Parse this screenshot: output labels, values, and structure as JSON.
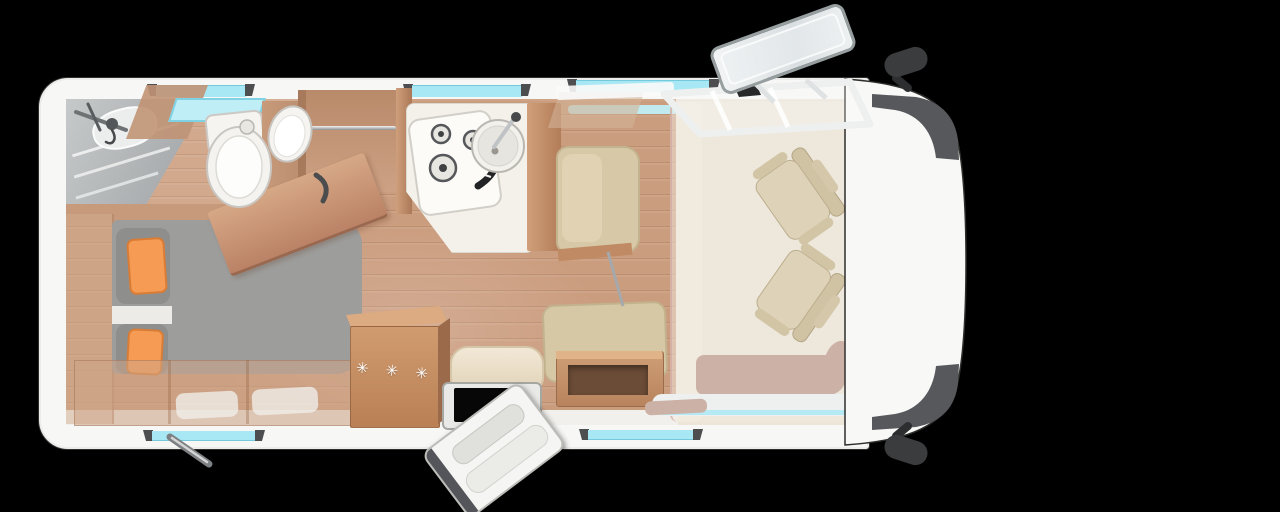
{
  "meta": {
    "description": "Top-down 3D floor plan render of a motorhome on a black background",
    "background_color": "#000000"
  },
  "fridge": {
    "marker": "✳ ✳ ✳"
  },
  "palette": {
    "body_white": "#f7f7f5",
    "floor_wood": "#c89878",
    "bath_floor_wood": "#d2a98d",
    "window_cyan": "#a8e7f4",
    "window_cap_gray": "#4c4e50",
    "accent_orange": "#f59b53",
    "blanket_orange": "#f79a4e",
    "mattress_gray": "#9d9d9b",
    "upholstery_khaki": "#d6c8a6",
    "cab_seat_beige": "#ded3b8",
    "furniture_wood": "#c08a64",
    "windshield_gray": "#56585c",
    "mirror_dark": "#3a3c3e",
    "rose_step": "#ccb2a6",
    "cream_floor_cab": "#ece5d8"
  },
  "features": {
    "bathroom": [
      "shower-fixture",
      "shower-shelves",
      "toilet",
      "washbasin",
      "bathroom-rooflight",
      "open-bathroom-door"
    ],
    "bedroom": [
      "french-bed",
      "head-cushions",
      "orange-pillows",
      "orange-blanket",
      "under-bed-storage",
      "rear-wardrobe-column"
    ],
    "kitchen": [
      "three-burner-hob",
      "round-sink",
      "kitchen-counter",
      "tall-cabinet",
      "wardrobe-with-rail"
    ],
    "lounge": [
      "forward-bench-seat",
      "side-bench-seat",
      "sideboard-table",
      "entrance-bench-seat",
      "drop-down-bed-partition"
    ],
    "cab": [
      "driver-swivel-seat",
      "passenger-swivel-seat",
      "windshield",
      "left-mirror",
      "right-mirror",
      "open-roof-hatch",
      "cab-step"
    ],
    "exterior": [
      "entrance-door-open",
      "entry-step",
      "corner-steady-jack",
      "wall-windows",
      "rooflights"
    ]
  },
  "counts": {
    "hob_burners": 3,
    "cab_seats": 2,
    "pillows": 2,
    "wall_windows_top": 3,
    "wall_windows_bottom": 2,
    "rooflights": 2
  }
}
